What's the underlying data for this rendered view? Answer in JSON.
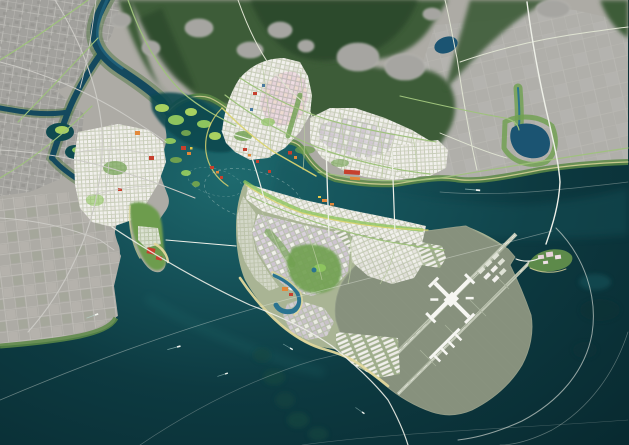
{
  "scene": {
    "label": "aerial-masterplan-rendering-coastal-city-with-offshore-airport",
    "features": [
      "old-city-grid",
      "river-wetlands",
      "forested-hills",
      "hillside-villages",
      "northern-new-town",
      "western-new-town",
      "eastern-grid-town",
      "central-bay",
      "bay-marsh-islets",
      "ferry-route-circle",
      "waterfront-landmark-buildings",
      "western-peninsula-resort",
      "southern-peninsula-new-town",
      "beach-waterfront",
      "lagoon-resort",
      "warehouse-logistics-district",
      "reclaimed-airport-platform",
      "airport-terminal",
      "runways",
      "cargo-aprons",
      "harbor-island",
      "coastal-lake",
      "greenway-canal",
      "cross-bay-bridges",
      "sea-crossing-highways",
      "shipping-lane-arcs",
      "boats",
      "sea-shoals"
    ]
  },
  "colors": {
    "seaDeep": "#082b31",
    "seaMid": "#0e3d44",
    "seaBay": "#1a6168",
    "seaShallow": "#2f8b86",
    "strait": "#17545c",
    "river": "#14495e",
    "riverLight": "#2a7390",
    "lake": "#1b5472",
    "marshWater": "#0f4a50",
    "grayCity": "#a2a19d",
    "grayLine": "#bfbeb9",
    "grayDark": "#8f8e8a",
    "farm": "#adaba5",
    "farmLine": "#c3c1bb",
    "plain": "#b0afaa",
    "plainLine": "#bebdb7",
    "hillDark": "#2c462b",
    "hill": "#3c5c38",
    "hillLight": "#527743",
    "village": "#a6a5a1",
    "park": "#6fa04f",
    "bright": "#8dc45e",
    "marshGreen": "#a8d060",
    "sand": "#e0d79c",
    "yellowRoad": "#d9d470",
    "street": "#c8cdb9",
    "blockWhite": "#f1f0ec",
    "lavender": "#cfc5d1",
    "pink": "#e6d2d9",
    "pinkStreet": "#c2bab8",
    "red": "#c6402e",
    "orange": "#e2883a",
    "yellowAcc": "#e5c94b",
    "blueAcc": "#49799f",
    "roadLight": "#cbcac5",
    "roadGreen": "#9ec27b",
    "roadPale": "#dfe3d2",
    "bridge": "#eef0e8",
    "plat": "#87917d",
    "platLine": "#939d88",
    "runway": "#c4cab9",
    "terminal": "#f6f6f2",
    "apron": "#dfe2d6"
  }
}
